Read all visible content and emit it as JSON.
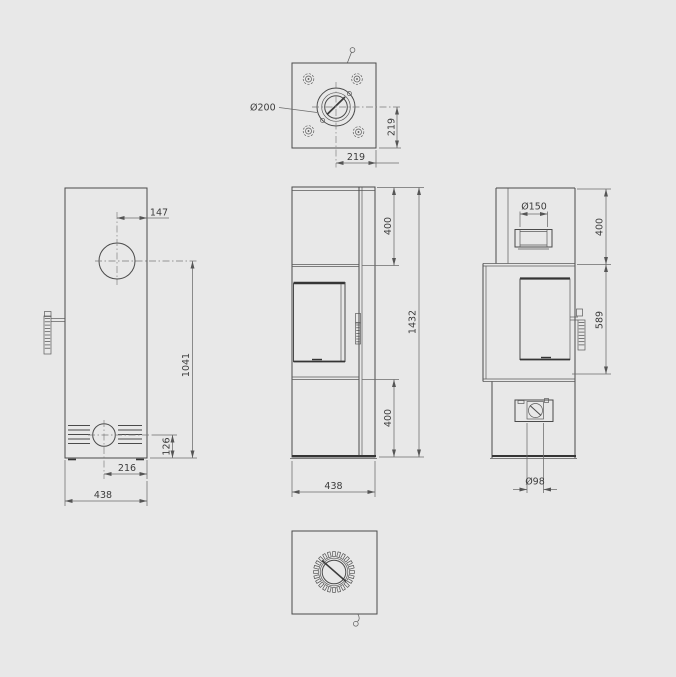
{
  "drawing": {
    "background": "#e8e8e8",
    "line_color": "#4a4a4a",
    "dim_line_color": "#6b6b6b",
    "text_color": "#3c3c3c"
  },
  "views": {
    "top": {
      "label": "top-view",
      "dims": {
        "flue_diameter": "Ø200",
        "center_to_edge_v": "219",
        "center_to_edge_h": "219"
      }
    },
    "left": {
      "label": "left-side-view",
      "dims": {
        "flue_center_offset": "147",
        "flue_center_height": "1041",
        "intake_center_height": "126",
        "intake_center_offset": "216",
        "body_width": "438"
      }
    },
    "front": {
      "label": "front-view",
      "dims": {
        "upper_section_height": "400",
        "total_height": "1432",
        "lower_section_height": "400",
        "body_width": "438"
      }
    },
    "right": {
      "label": "right-side-view",
      "dims": {
        "rear_flue_diameter": "Ø150",
        "upper_section_height": "400",
        "door_section_height": "589",
        "air_inlet_diameter": "Ø98"
      }
    },
    "bottom": {
      "label": "bottom-view"
    }
  }
}
